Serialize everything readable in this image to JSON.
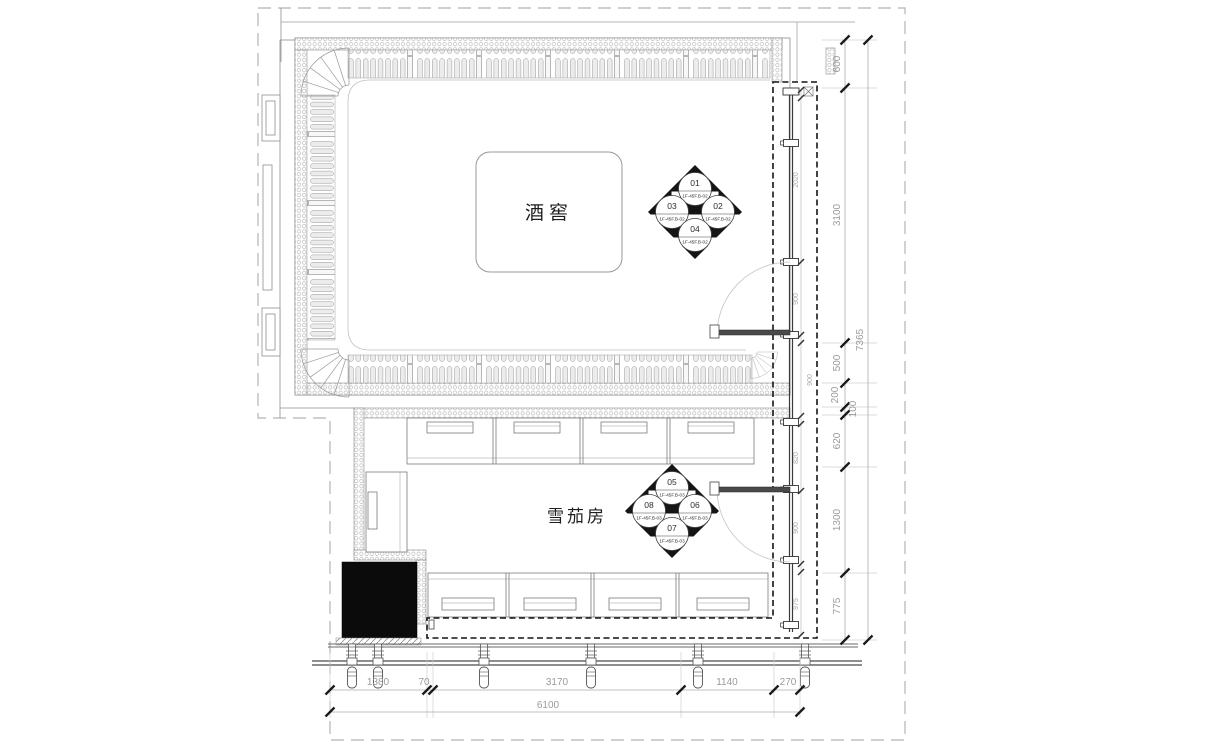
{
  "plan": {
    "room1_label": "酒窖",
    "room2_label": "雪茄房"
  },
  "markers": {
    "upper": {
      "top": {
        "num": "01",
        "ref": "1F-45F.B-02"
      },
      "right": {
        "num": "02",
        "ref": "1F-45F.B-02"
      },
      "left": {
        "num": "03",
        "ref": "1F-45F.B-02"
      },
      "bottom": {
        "num": "04",
        "ref": "1F-45F.B-02"
      }
    },
    "lower": {
      "top": {
        "num": "05",
        "ref": "1F-45F.B-03"
      },
      "right": {
        "num": "06",
        "ref": "1F-45F.B-03"
      },
      "left": {
        "num": "08",
        "ref": "1F-45F.B-03"
      },
      "bottom": {
        "num": "07",
        "ref": "1F-45F.B-03"
      }
    }
  },
  "dims": {
    "right_outer": {
      "values": [
        "600",
        "3100",
        "500",
        "200",
        "100",
        "620",
        "1300",
        "775"
      ],
      "total": "7365"
    },
    "right_inner": {
      "values": [
        "2020",
        "900",
        "900",
        "820",
        "900",
        "975"
      ]
    },
    "bottom": {
      "values": [
        "1380",
        "70",
        "3170",
        "1140",
        "270"
      ],
      "total": "6100"
    }
  },
  "colors": {
    "line": "#666666",
    "wall_hatch": "#adadad",
    "dim_text": "#9a9a9a",
    "solid_column": "#0b0b0b",
    "glass_dash": "#141414"
  }
}
